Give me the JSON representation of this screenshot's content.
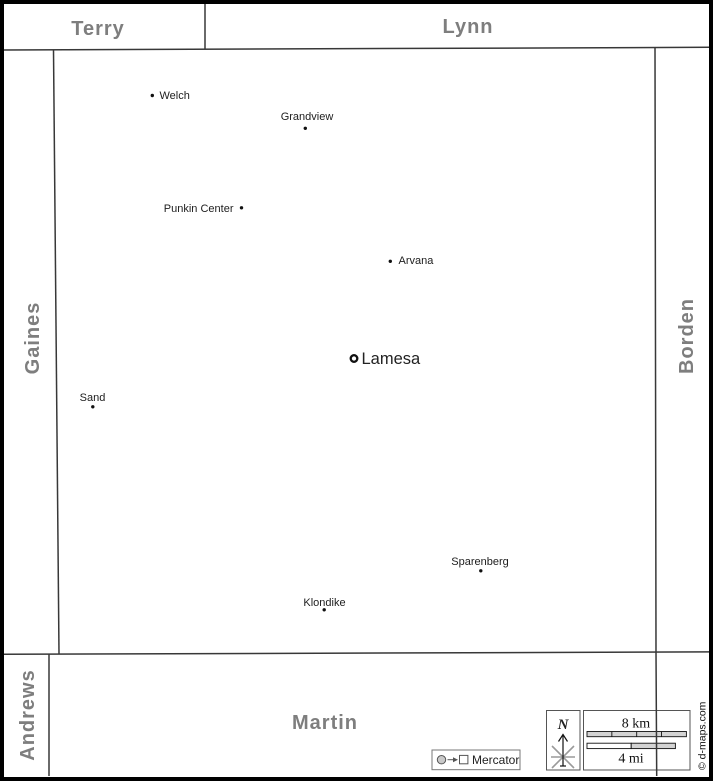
{
  "neighbors": {
    "top_left": "Terry",
    "top_right": "Lynn",
    "west": "Gaines",
    "east": "Borden",
    "south_west": "Andrews",
    "south": "Martin"
  },
  "county_seat": {
    "name": "Lamesa"
  },
  "towns": [
    {
      "name": "Welch"
    },
    {
      "name": "Grandview"
    },
    {
      "name": "Punkin Center"
    },
    {
      "name": "Arvana"
    },
    {
      "name": "Sand"
    },
    {
      "name": "Sparenberg"
    },
    {
      "name": "Klondike"
    }
  ],
  "legend": {
    "north_label": "N",
    "scale_km_label": "8 km",
    "scale_mi_label": "4 mi",
    "projection_label": "Mercator",
    "credit": "© d-maps.com"
  },
  "colors": {
    "neighbor_label": "#7e7e7e",
    "boundary_line": "#383838",
    "town_label": "#1d1d1d",
    "scale_fill": "#d3d3d3",
    "frame": "#000000"
  }
}
